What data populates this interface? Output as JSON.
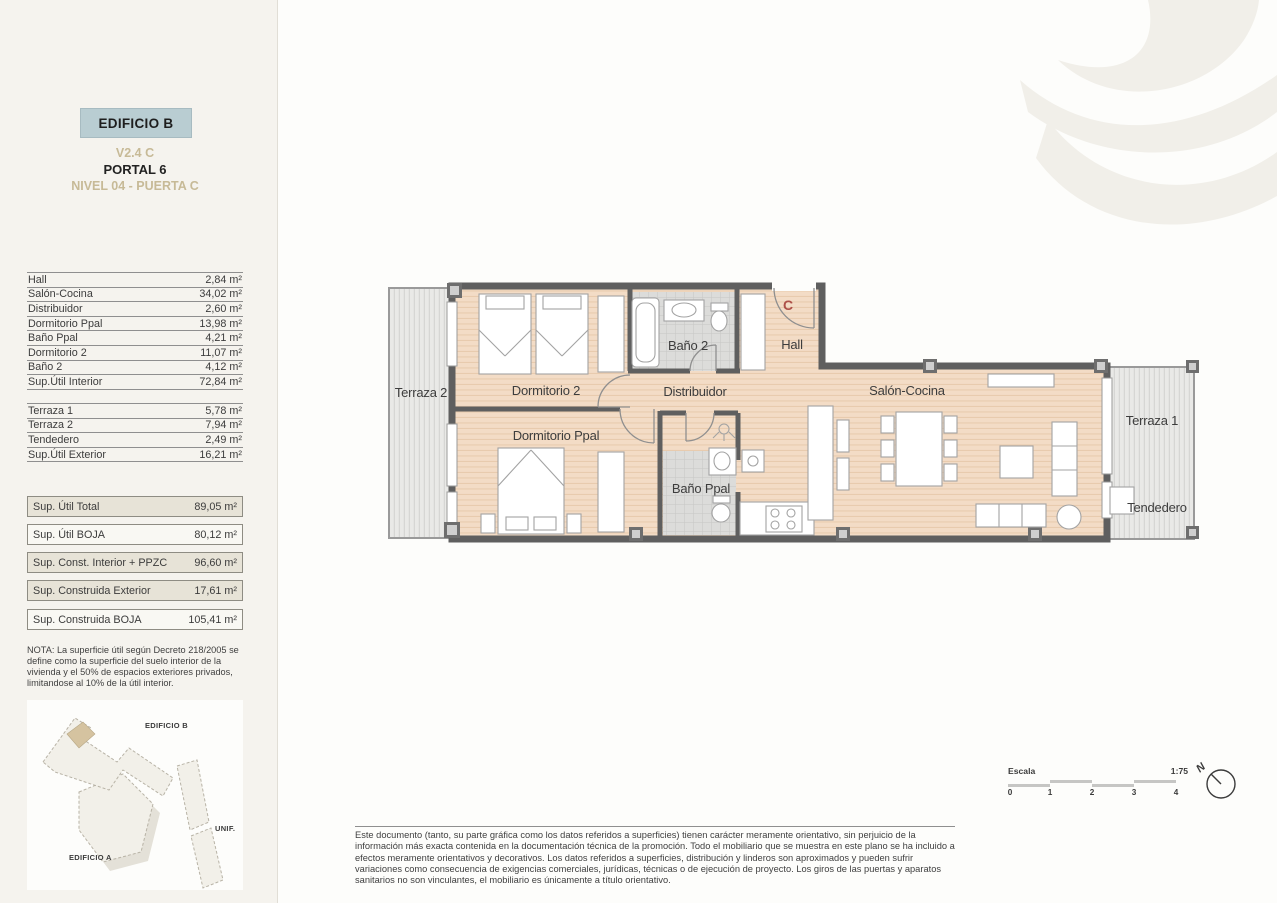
{
  "header": {
    "building": "EDIFICIO B",
    "unit_code": "V2.4 C",
    "portal": "PORTAL 6",
    "level": "NIVEL 04 - PUERTA C"
  },
  "areas_interior": {
    "rows": [
      {
        "label": "Hall",
        "value": "2,84 m²"
      },
      {
        "label": "Salón-Cocina",
        "value": "34,02 m²"
      },
      {
        "label": "Distribuidor",
        "value": "2,60 m²"
      },
      {
        "label": "Dormitorio Ppal",
        "value": "13,98 m²"
      },
      {
        "label": "Baño Ppal",
        "value": "4,21 m²"
      },
      {
        "label": "Dormitorio 2",
        "value": "11,07 m²"
      },
      {
        "label": "Baño 2",
        "value": "4,12 m²"
      },
      {
        "label": "Sup.Útil Interior",
        "value": "72,84 m²"
      }
    ]
  },
  "areas_exterior": {
    "rows": [
      {
        "label": "Terraza 1",
        "value": "5,78 m²"
      },
      {
        "label": "Terraza 2",
        "value": "7,94 m²"
      },
      {
        "label": "Tendedero",
        "value": "2,49 m²"
      },
      {
        "label": "Sup.Útil Exterior",
        "value": "16,21 m²"
      }
    ]
  },
  "summary_boxes": [
    {
      "label": "Sup. Útil Total",
      "value": "89,05 m²"
    },
    {
      "label": "Sup. Útil BOJA",
      "value": "80,12 m²"
    },
    {
      "label": "Sup. Const. Interior + PPZC",
      "value": "96,60 m²"
    },
    {
      "label": "Sup. Construida Exterior",
      "value": "17,61 m²"
    },
    {
      "label": "Sup. Construida BOJA",
      "value": "105,41 m²"
    }
  ],
  "nota": "NOTA: La superficie útil según Decreto 218/2005 se define como la superficie del suelo interior de la vivienda y el 50% de espacios exteriores privados, limitandose al 10% de la útil interior.",
  "siteplan": {
    "edificio_b": "EDIFICIO B",
    "unif": "UNIF.",
    "edificio_a": "EDIFICIO A"
  },
  "plan": {
    "entry_letter": "C",
    "rooms": {
      "terraza2": "Terraza 2",
      "dormitorio2": "Dormitorio 2",
      "dormitorio_ppal": "Dormitorio Ppal",
      "bano2": "Baño 2",
      "hall": "Hall",
      "distribuidor": "Distribuidor",
      "bano_ppal": "Baño Ppal",
      "salon_cocina": "Salón-Cocina",
      "terraza1": "Terraza 1",
      "tendedero": "Tendedero"
    }
  },
  "scale": {
    "label": "Escala",
    "ratio": "1:75",
    "ticks": [
      "0",
      "1",
      "2",
      "3",
      "4"
    ],
    "north": "N"
  },
  "disclaimer": "Este documento (tanto, su parte gráfica como los datos referidos a superficies) tienen carácter meramente orientativo, sin perjuicio de la información más exacta contenida en la documentación técnica de la promoción. Todo el mobiliario que se muestra en este plano se ha incluido a efectos meramente orientativos y decorativos. Los datos referidos a superficies, distribución y linderos son aproximados y pueden sufrir variaciones como consecuencia de exigencias comerciales, jurídicas, técnicas o de ejecución de proyecto. Los giros de las puertas y aparatos sanitarios no son vinculantes, el mobiliario es únicamente a título orientativo.",
  "colors": {
    "accent_box": "#b9cdd2",
    "accent_tan": "#c7ba97",
    "wall": "#5f5f5f",
    "wood_floor": "#f3dcc6",
    "terrace_floor": "#e9e9e7",
    "entry_letter": "#ad5048"
  }
}
